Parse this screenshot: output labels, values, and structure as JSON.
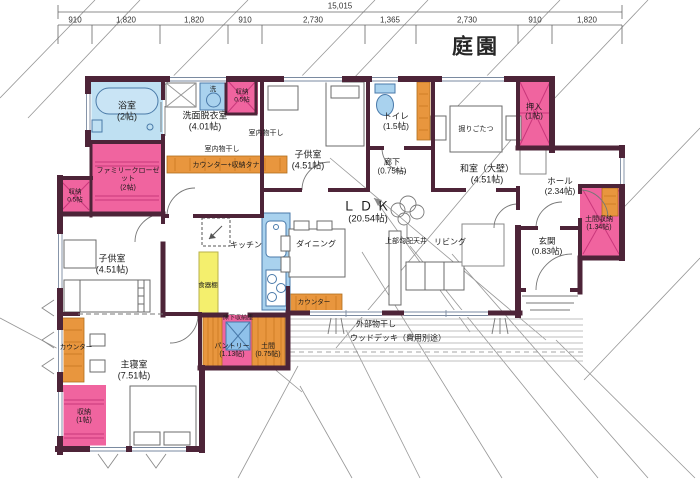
{
  "dimension_line": {
    "total": "15,015",
    "segments": [
      "910",
      "1,820",
      "1,820",
      "910",
      "2,730",
      "1,365",
      "2,730",
      "910",
      "1,820"
    ]
  },
  "garden": "庭園",
  "rooms": {
    "bathroom": {
      "name": "浴室",
      "size": "(2帖)"
    },
    "washroom": {
      "name": "洗面脱衣室",
      "size": "(4.01帖)"
    },
    "storage_top": {
      "name": "収納",
      "size": "0.5帖"
    },
    "kids_room_top": {
      "name": "子供室",
      "size": "(4.51帖)"
    },
    "toilet": {
      "name": "トイレ",
      "size": "(1.5帖)"
    },
    "corridor": {
      "name": "廊下",
      "size": "(0.75帖)"
    },
    "washitsu": {
      "name": "和室（大壁）",
      "size": "(4.51帖)"
    },
    "oshiire": {
      "name": "押入",
      "size": "(1帖)"
    },
    "hall": {
      "name": "ホール",
      "size": "(2.34帖)"
    },
    "doma_storage": {
      "name": "土間収納",
      "size": "(1.34帖)"
    },
    "genkan": {
      "name": "玄関",
      "size": "(0.83帖)"
    },
    "ldk": {
      "name": "ＬＤＫ",
      "size": "(20.54帖)"
    },
    "family_closet": {
      "name": "ファミリークローゼット",
      "size": "(2帖)"
    },
    "storage_left": {
      "name": "収納",
      "size": "0.5帖"
    },
    "kids_room_bottom": {
      "name": "子供室",
      "size": "(4.51帖)"
    },
    "master_bedroom": {
      "name": "主寝室",
      "size": "(7.51帖)"
    },
    "storage_master": {
      "name": "収納",
      "size": "(1帖)"
    },
    "pantry": {
      "name": "パントリー",
      "size": "(1.13帖)"
    },
    "doma": {
      "name": "土間",
      "size": "(0.75帖)"
    }
  },
  "labels": {
    "laundry": "洗",
    "indoor_drying_1": "室内物干し",
    "indoor_drying_2": "室内物干し",
    "counter_shelf": "カウンター+収納タナ",
    "kitchen": "キッチン",
    "cupboard": "食器棚",
    "underfloor_storage": "床下収納庫",
    "dining": "ダイニング",
    "living": "リビング",
    "sloped_ceiling": "上部勾配天井",
    "kotatsu": "掘りごたつ",
    "counter_bedroom": "カウンター",
    "counter_ldk": "カウンター",
    "outdoor_drying": "外部物干し",
    "wood_deck": "ウッドデッキ（費用別途）"
  },
  "colors": {
    "wall": "#4d2438",
    "closet_pink": "#f0649f",
    "water_blue": "#a9d2ee",
    "wood_orange": "#e8963e",
    "cabinet_yellow": "#f4ef6d"
  }
}
